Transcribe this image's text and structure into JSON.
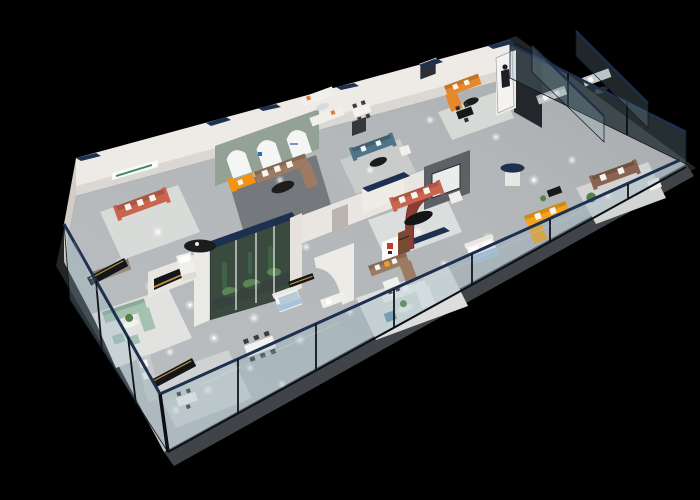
{
  "image": {
    "type": "3d-isometric-floorplan-render",
    "subject": "furniture showroom interior cutaway",
    "width_px": 700,
    "height_px": 500
  },
  "palette": {
    "background": "#000000",
    "slab": "#222426",
    "apron": "#404448",
    "floor": "#b3b7b9",
    "floor_bright": "#cdd0d0",
    "rug_light": "#d9dbd9",
    "rug_dark": "#75787c",
    "wall": "#eeebe6",
    "wall_shade": "#d2cec7",
    "navy": "#1e3050",
    "glass": "#8fb0bd",
    "glass_edge": "#0d1420",
    "arch_wall": "#93a294",
    "arch_window": "#f4f6f6",
    "tv_wall": "#5d6165",
    "tv_screen": "#ebecec",
    "feature_red": "#8e3c34",
    "logo_red": "#c23b2e",
    "sofa_orange": "#e8882c",
    "sofa_amber": "#f2a120",
    "chaise_orange": "#f5920f",
    "sofa_rust": "#c9654e",
    "sofa_brown": "#9d7b63",
    "sofa_leather": "#8a6450",
    "sofa_taupe": "#978b80",
    "sofa_teal": "#50748a",
    "ottoman_teal": "#6b99a8",
    "sofa_sage": "#a5c1b0",
    "sofa_gray": "#c6cbca",
    "sofa_white": "#f1efec",
    "bed_blue": "#a9c2da",
    "bed_white": "#f4f3f1",
    "table_black": "#1b1c1e",
    "console_black": "#141518",
    "gold_trim": "#b9923f",
    "plant_green": "#55824a",
    "plant_dark": "#2f5233",
    "terrarium_glass": "#6f8a77",
    "terrarium_back": "#26322a",
    "spotlight": "#ffffff",
    "standee_panel": "#f4f3f1",
    "figure_dark": "#1d1f24"
  },
  "scene": {
    "areas": [
      {
        "name": "lounge-display-1",
        "items": [
          "rust-red sofa with white cushions",
          "black oval coffee table",
          "green wall sign"
        ]
      },
      {
        "name": "arched-window-lounge",
        "items": [
          "orange chaise lounge",
          "brown sectional sofa",
          "black coffee tables",
          "three arched windows"
        ]
      },
      {
        "name": "teal-sofa-lounge",
        "items": [
          "teal sofa",
          "black round table",
          "white sofas with glass table"
        ]
      },
      {
        "name": "tv-feature-lounge",
        "items": [
          "rust sofa",
          "gray tv feature wall",
          "red curved partition",
          "navy pedestal table"
        ]
      },
      {
        "name": "corner-suite",
        "items": [
          "orange corner sofa",
          "promo standee of woman",
          "black dining set",
          "dark wall art"
        ]
      },
      {
        "name": "glazed-wing",
        "items": [
          "gray sofas behind glass",
          "brown leather sofa",
          "white armchair",
          "amber corner sofa",
          "bed with blue throw"
        ]
      },
      {
        "name": "center-gallery",
        "items": [
          "planted terrarium wall",
          "white modular sofa",
          "teal ottoman",
          "curved niche wall",
          "black media console",
          "blue loveseat",
          "brown corner sofa",
          "bed with blue throw",
          "white daybed"
        ]
      },
      {
        "name": "front-lounges",
        "items": [
          "sage green sofa set with round table",
          "gray corner sofa",
          "six-seat dining table",
          "black sideboards with gold trim",
          "taupe sofa"
        ]
      }
    ],
    "architecture": [
      "long glass facade with navy top rail",
      "glass end wall and glass partitions",
      "white partition walls with navy caps",
      "ceiling spotlight glows on gray floor"
    ]
  }
}
